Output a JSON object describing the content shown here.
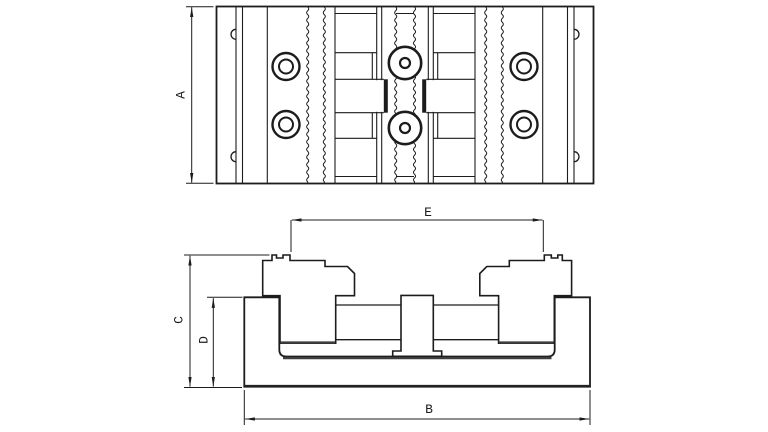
{
  "dimensions": {
    "a": "A",
    "b": "B",
    "c": "C",
    "d": "D",
    "e": "E"
  },
  "colors": {
    "line": "#1c1c1c",
    "shadow_line": "#3f3f3f",
    "background": "#ffffff"
  }
}
